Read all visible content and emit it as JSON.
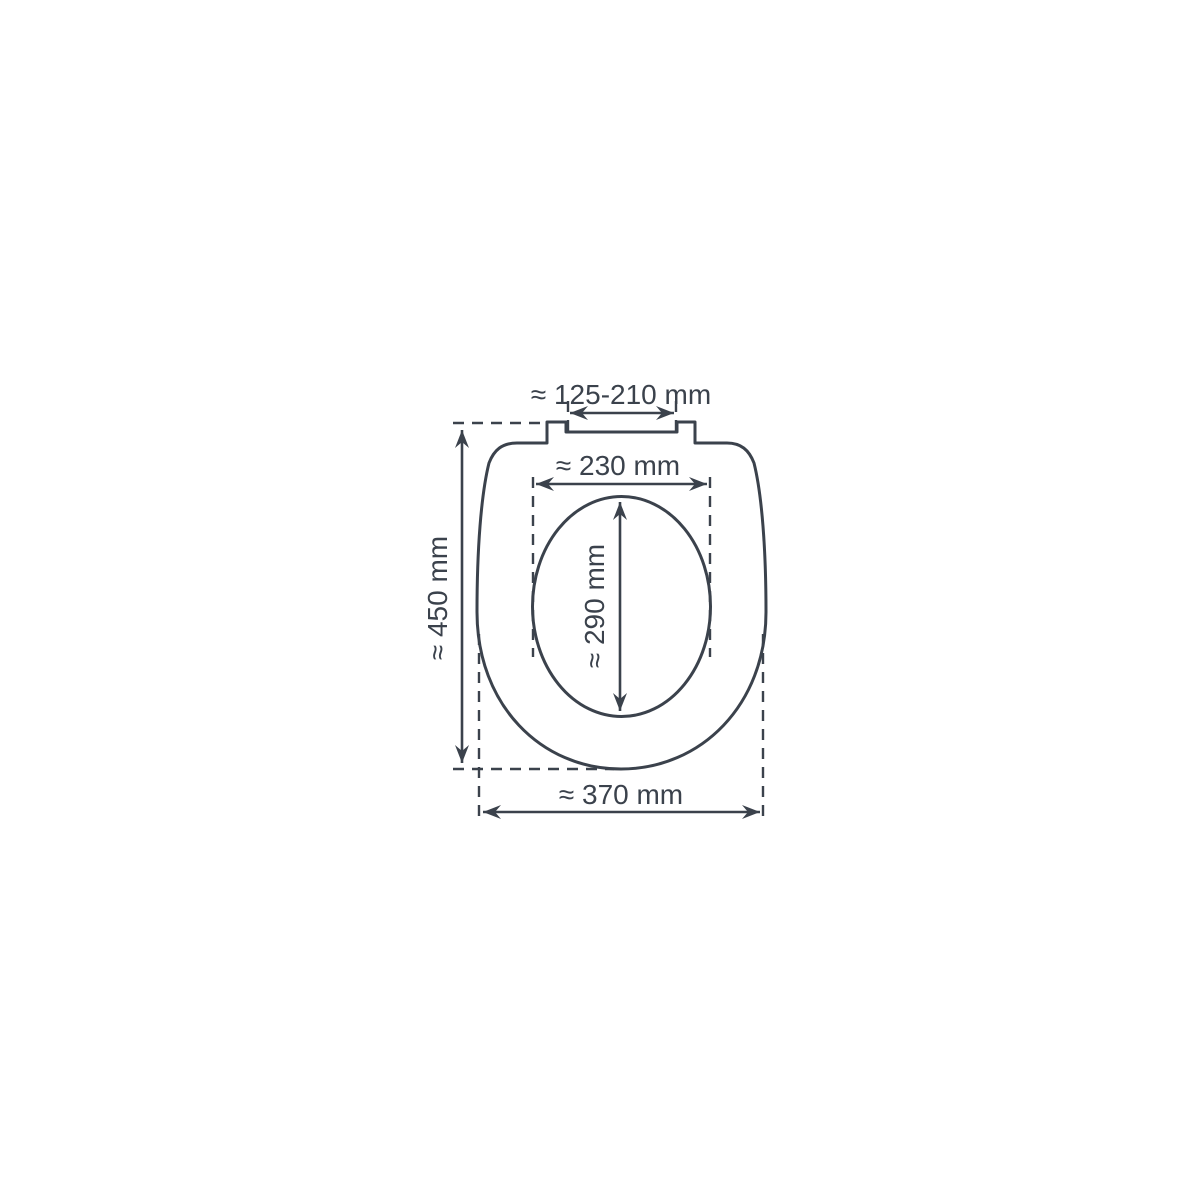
{
  "diagram": {
    "title": "toilet-seat-dimension-drawing",
    "line_color": "#3b424c",
    "background_color": "#ffffff",
    "labels": {
      "hinge_width": "≈ 125-210 mm",
      "inner_width": "≈ 230 mm",
      "inner_length": "≈ 290 mm",
      "total_length": "≈ 450 mm",
      "total_width": "≈ 370 mm"
    },
    "dimensions_mm": {
      "hinge_width_min": 125,
      "hinge_width_max": 210,
      "inner_width": 230,
      "inner_length": 290,
      "total_length": 450,
      "total_width": 370
    }
  }
}
